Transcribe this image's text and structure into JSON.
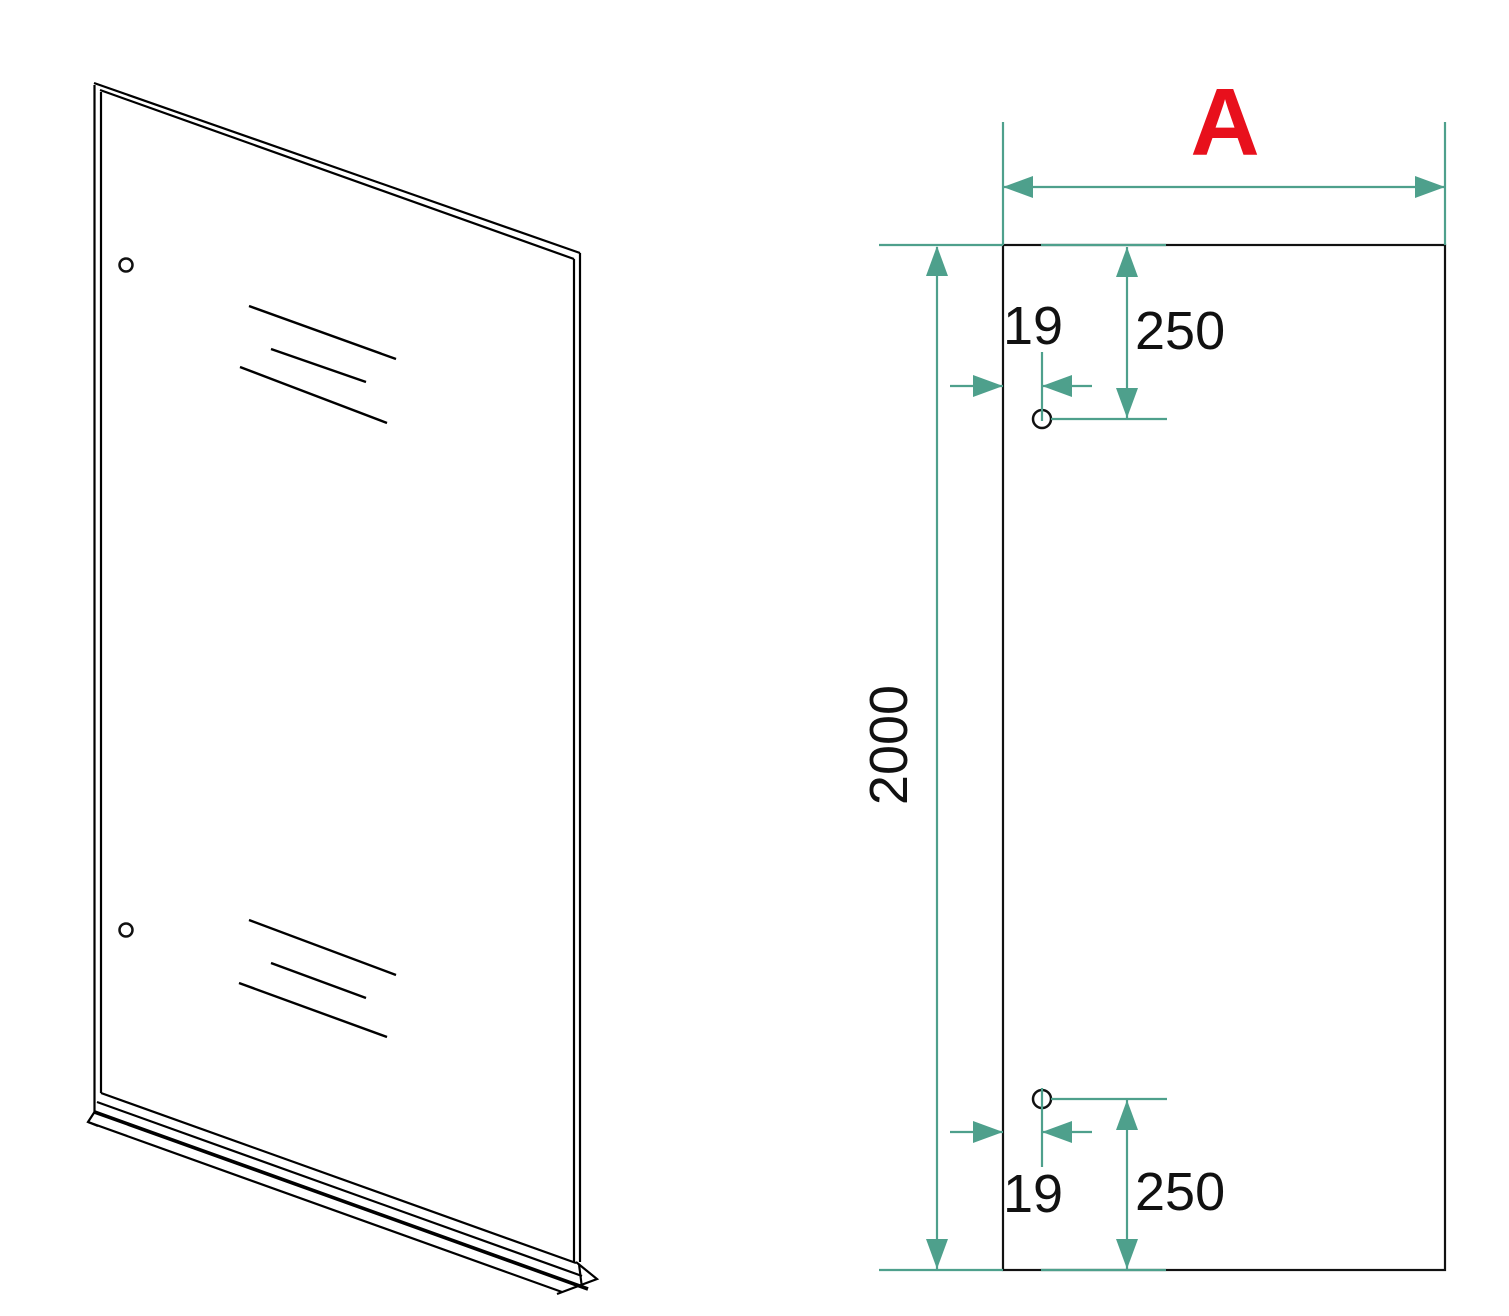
{
  "colors": {
    "dimension_lines": "#4EA08C",
    "label": "#E8101C",
    "drawing_lines": "#000000",
    "background": "#FFFFFF"
  },
  "iso_view": {
    "description": "perspective view of glass panel with two mounting holes and bottom profile bar"
  },
  "front_view": {
    "width_label": "A",
    "height_dim": "2000",
    "top_hole": {
      "edge_offset": "19",
      "vertical_offset": "250"
    },
    "bottom_hole": {
      "edge_offset": "19",
      "vertical_offset": "250"
    }
  }
}
